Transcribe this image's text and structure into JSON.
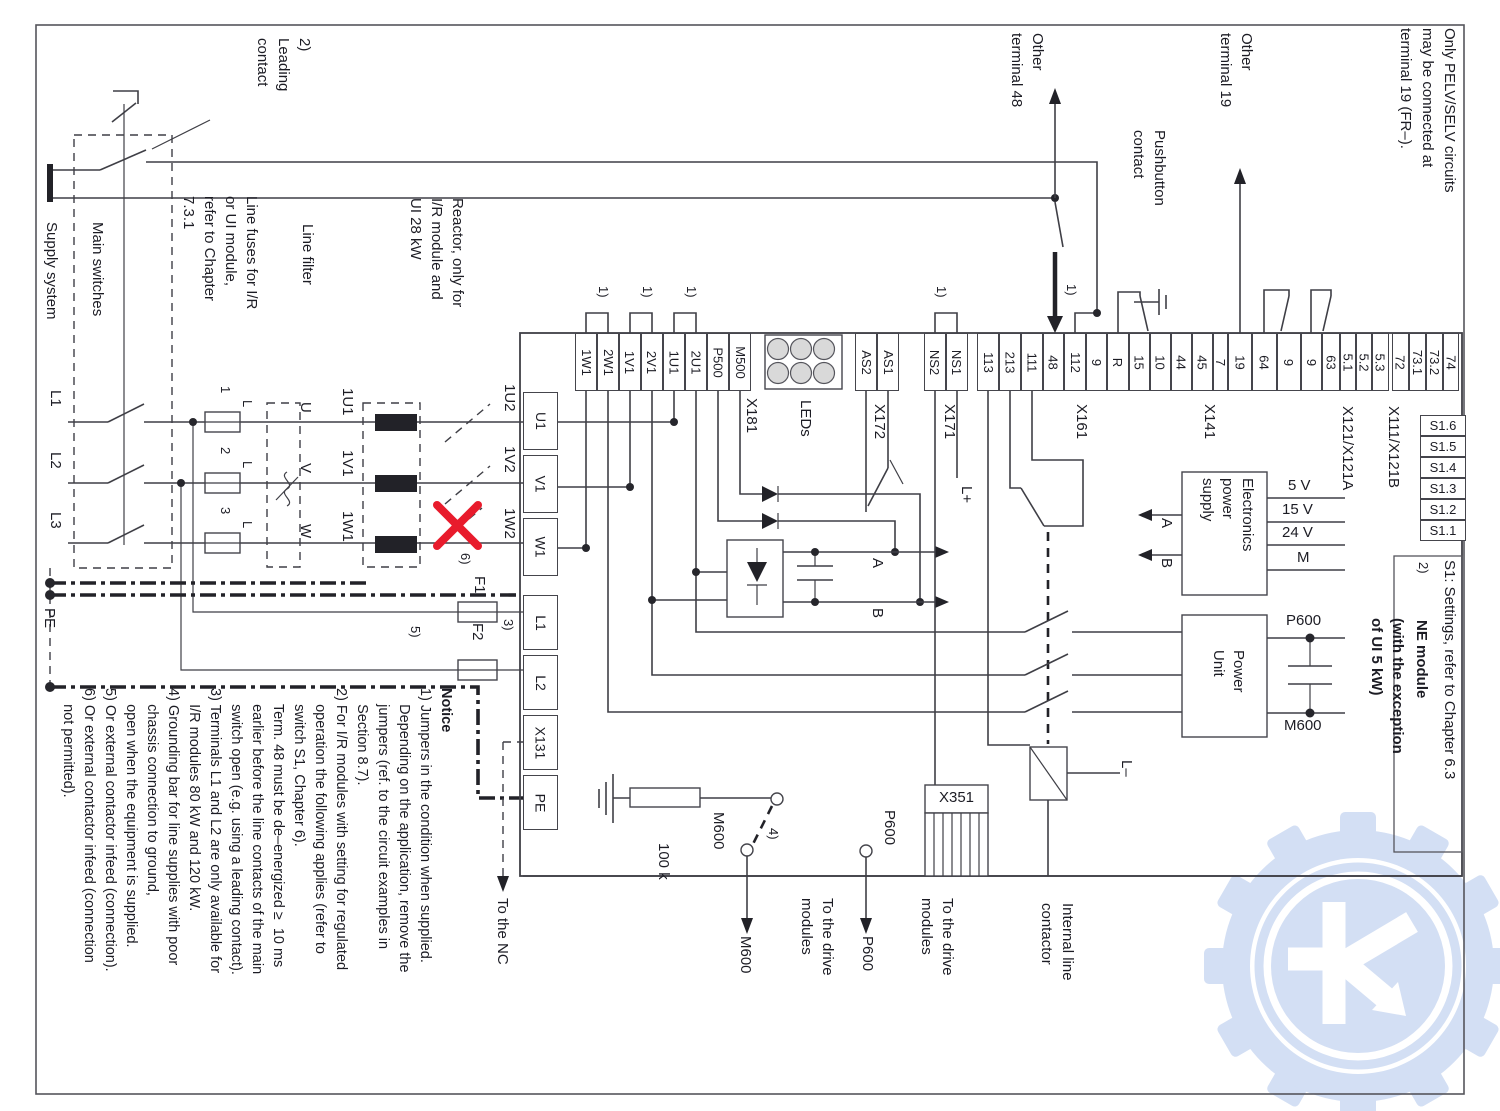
{
  "ann": {
    "leading_contact": "2)\nLeading\ncontact",
    "supply_system": "Supply system",
    "main_switches": "Main switches",
    "line_fuses": "Line fuses for I/R\nor UI module,\nrefer to Chapter\n7.3.1",
    "line_filter": "Line filter",
    "reactor": "Reactor, only for\nI/R module and\nUI 28 kW",
    "l1": "L1",
    "l2": "L2",
    "l3": "L3",
    "pe": "PE",
    "f_num1": "1",
    "f_num2": "2",
    "f_num3": "3",
    "f_l": "L",
    "u": "U",
    "v": "V",
    "w": "W",
    "n1u1": "1U1",
    "n1v1": "1V1",
    "n1w1": "1W1",
    "n1u2": "1U2",
    "n1v2": "1V2",
    "n1w2": "1W2",
    "note1": "1)",
    "note2": "2)",
    "note3": "3)",
    "note4": "4)",
    "note5": "5)",
    "note6": "6)",
    "f1": "F1",
    "f2": "F2",
    "x181": "X181",
    "leds": "LEDs",
    "x172": "X172",
    "x171": "X171",
    "x161": "X161",
    "x141": "X141",
    "x121": "X121/X121A",
    "x111": "X111/X121B",
    "x351": "X351",
    "l_plus": "L+",
    "l_minus": "L–",
    "other48": "Other\nterminal 48",
    "pushbutton": "Pushbutton\ncontact",
    "other19": "Other\nterminal 19",
    "pelv": "Only PELV/SELV circuits\nmay be connected at\nterminal 19 (FR–).",
    "eps": "Electronics\npower\nsupply",
    "power_unit": "Power\nUnit",
    "v5": "5 V",
    "v15": "15 V",
    "v24": "24 V",
    "m": "M",
    "p600": "P600",
    "m600": "M600",
    "a": "A",
    "b": "B",
    "k100": "100 k",
    "to_nc": "To the NC",
    "to_drive": "To the drive\nmodules",
    "internal_contactor": "Internal line\ncontactor",
    "s1_settings": "S1: Settings, refer to Chapter 6.3",
    "ne_module": "NE module",
    "ne_exception": "(with the exception\nof UI 5 kW)"
  },
  "module": {
    "terminals": [
      "U1",
      "V1",
      "W1",
      "L1",
      "L2",
      "X131",
      "PE"
    ]
  },
  "strips": {
    "x181": [
      "1W1",
      "2W1",
      "1V1",
      "2V1",
      "1U1",
      "2U1",
      "P500",
      "M500"
    ],
    "x172": [
      "AS2",
      "AS1"
    ],
    "x171": [
      "NS2",
      "NS1"
    ],
    "x161": [
      "113",
      "213",
      "111",
      "48",
      "112",
      "9"
    ],
    "x141": [
      "R",
      "15",
      "10",
      "44",
      "45",
      "7"
    ],
    "x121": [
      "19",
      "64",
      "9",
      "9",
      "63",
      "5.1",
      "5.2",
      "5.3"
    ],
    "x111": [
      "72",
      "73.1",
      "73.2",
      "74"
    ]
  },
  "s1": [
    "S1.6",
    "S1.5",
    "S1.4",
    "S1.3",
    "S1.2",
    "S1.1"
  ],
  "notice": {
    "title": "Notice",
    "body": "\n1) Jumpers in the condition when supplied.\n    Depending on the application, remove the\n    jumpers (ref. to the circuit examples in\n    Section 8.7).\n2) For I/R modules with setting for regulated\n    operation the following applies (refer to\n    switch S1, Chapter 6).\n    Term. 48 must be de–energized ≥  10 ms\n    earlier before the line contacts of the main\n    switch open (e.g. using a leading contact).\n3) Terminals L1 and L2 are only available for\n    I/R modules 80 kW and 120 kW.\n4) Grounding bar for line supplies with poor\n    chassis connection to ground,\n    open when the equipment is supplied.\n5) Or external contactor infeed (connection).\n6) Or external contactor infeed (connection\n    not permitted)."
  }
}
